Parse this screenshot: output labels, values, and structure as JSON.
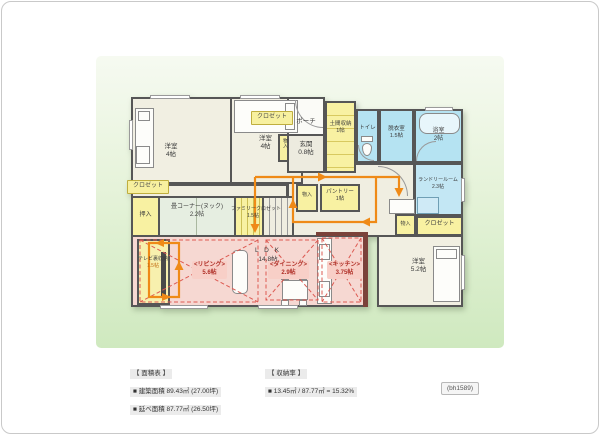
{
  "plan": {
    "bedroom_a": {
      "name": "洋室",
      "size": "4帖"
    },
    "bedroom_b": {
      "name": "洋室",
      "size": "4帖"
    },
    "closet_top_badge": "クロゼット",
    "porch": "ポーチ",
    "entrance": {
      "name": "玄関",
      "size": "0.8帖"
    },
    "entrance_storage": "物入",
    "doma_storage": {
      "name": "土間収納",
      "size": "1帖"
    },
    "toilet": "トイレ",
    "dressing_room": {
      "name": "脱衣室",
      "size": "1.5帖"
    },
    "bathroom": {
      "name": "浴室",
      "size": "2帖"
    },
    "laundry_room": {
      "name": "ランドリールーム",
      "size": "2.3帖"
    },
    "closet_left_badge": "クロゼット",
    "oshiire": "押入",
    "tatami_nook": {
      "name": "畳コーナー(ヌック)",
      "size": "2.2帖"
    },
    "family_closet": {
      "name": "ファミリークロゼット",
      "size": "1.5帖"
    },
    "hall_storage": "物入",
    "pantry": {
      "name": "パントリー",
      "size": "1帖"
    },
    "bedroom_c_storage": "物入",
    "closet_right_badge": "クロゼット",
    "ldk": {
      "name": "L D K",
      "size": "14.8帖"
    },
    "living": {
      "name": "<リビング>",
      "size": "5.6帖"
    },
    "dining": {
      "name": "<ダイニング>",
      "size": "2.9帖"
    },
    "kitchen": {
      "name": "<キッチン>",
      "size": "3.75帖"
    },
    "tv_storage": {
      "name": "テレビ裏収納",
      "size": "1.5帖"
    },
    "bedroom_c": {
      "name": "洋室",
      "size": "5.2帖"
    }
  },
  "legend": {
    "area_title": "【 面積表 】",
    "area_rows": [
      "■ 建築面積  89.43㎡ (27.00坪)",
      "■ 延べ面積  87.77㎡ (26.50坪)"
    ],
    "storage_title": "【 収納率 】",
    "storage_rows": [
      "■ 13.45㎡ / 87.77㎡ = 15.32%"
    ]
  },
  "footer": {
    "code": "(bh1589)"
  },
  "colors": {
    "flow_orange": "#ef8a17",
    "sight_red": "#dd5a52",
    "wet_blue": "#b5e3f2",
    "storage_yellow": "#f8f1a2",
    "ldk_pink": "#f6d8d2",
    "wall_gray": "#565656",
    "kitchen_wall": "#7b423a"
  }
}
